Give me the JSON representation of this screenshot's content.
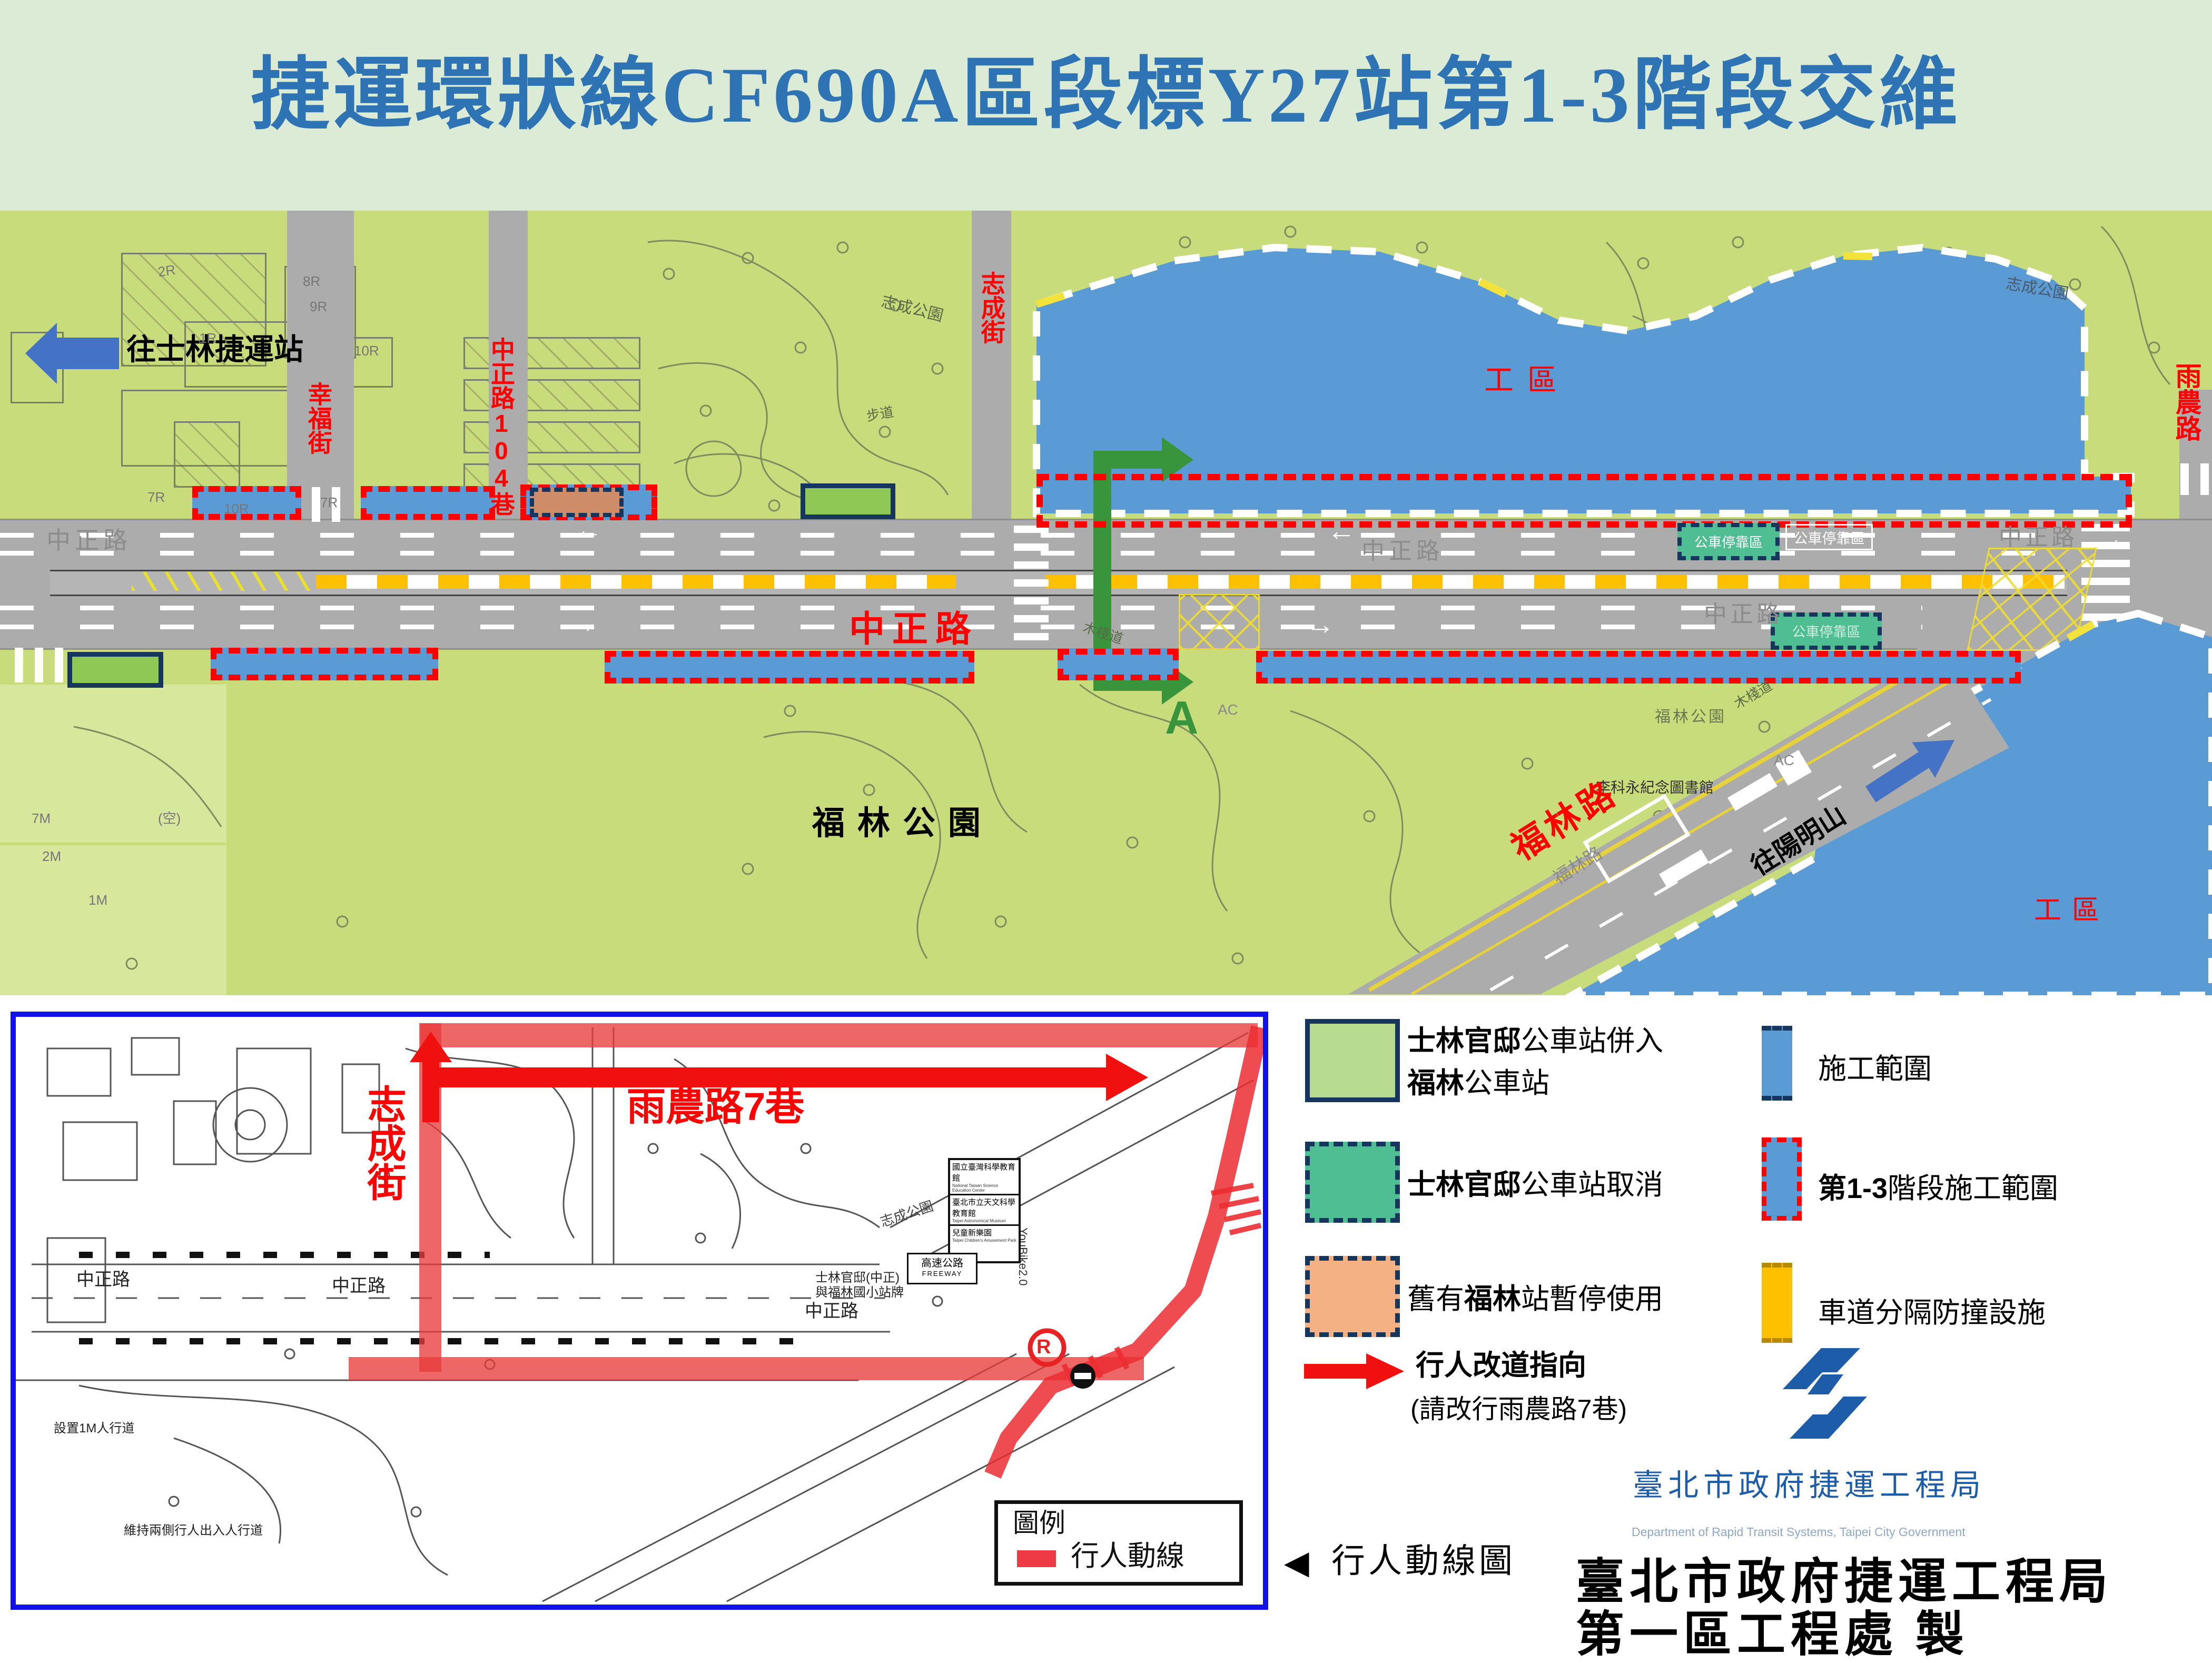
{
  "title": "捷運環狀線CF690A區段標Y27站第1-3階段交維",
  "map": {
    "to_shilin": "往士林捷運站",
    "xingfu_st": "幸福街",
    "zz104": "中正路104巷",
    "zhicheng_st": "志成街",
    "zhicheng_park": "志成公園",
    "budao": "步道",
    "gongqu": "工區",
    "zhongzheng_red": "中正路",
    "zhongzheng": "中正路",
    "fulin_park": "福林公園",
    "library": "李科永紀念圖書館",
    "fulin_rd": "福林路",
    "to_yangmingshan": "往陽明山",
    "yunong_rd": "雨農路",
    "a_marker": "A",
    "bus_bay": "公車停靠區",
    "boardwalk": "木棧道",
    "arrow_left": "←",
    "arrow_right": "→",
    "tiny": {
      "a": "2R",
      "b": "8R",
      "c": "9R",
      "d": "1R",
      "e": "10R",
      "f": "7R",
      "g": "2M",
      "h": "1M",
      "i": "(空)",
      "j": "AC",
      "k": "7M"
    }
  },
  "inset": {
    "zhicheng_st": "志成街",
    "yunong7": "雨農路7巷",
    "zhongzheng": "中正路",
    "zhicheng_park": "志成公園",
    "legend_title": "圖例",
    "legend_item": "行人動線",
    "sign1": "國立臺灣科學教育館",
    "sign1e": "National Taiwan Science Education Center",
    "sign2": "臺北市立天文科學教育館",
    "sign2e": "Taipei Astronomical Museum",
    "sign3": "兒童新樂園",
    "sign3e": "Taipei Children's Amusement Park",
    "freeway": "高速公路",
    "freeway_e": "FREEWAY",
    "busstop_note1": "士林官邸(中正)",
    "busstop_note2": "與福林國小站牌",
    "note_1m": "設置1M人行道",
    "note_ped": "維持兩側行人出入人行道",
    "youbike": "YouBike2.0",
    "r_mark": "R"
  },
  "legend": {
    "merge_bold1": "士林官邸",
    "merge_rest1": "公車站併入",
    "merge_bold2": "福林",
    "merge_rest2": "公車站",
    "cancel_bold": "士林官邸",
    "cancel_rest": "公車站取消",
    "old_pre": "舊有",
    "old_bold": "福林",
    "old_rest": "站暫停使用",
    "divert_title": "行人改道指向",
    "divert_sub": "(請改行雨農路7巷)",
    "construction": "施工範圍",
    "phase_bold": "第1-3",
    "phase_rest": "階段施工範圍",
    "barrier": "車道分隔防撞設施"
  },
  "logo": {
    "cht": "臺北市政府捷運工程局",
    "eng": "Department of Rapid Transit Systems, Taipei City Government"
  },
  "footer": {
    "tri": "◀",
    "ped_map": "行人動線圖",
    "line1": "臺北市政府捷運工程局",
    "line2": "第一區工程處  製"
  },
  "colors": {
    "title_blue": "#2E74B5",
    "work_blue": "#5B9BD5",
    "park_green": "#C9DC7B",
    "legend_green": "#B7DB8F",
    "teal": "#4FBE92",
    "orange_stop": "#F4B183",
    "barrier_yellow": "#FFC000",
    "route_red": "#FF0000",
    "route_green": "#38953C",
    "navy": "#17365D",
    "logo_blue": "#1D5CA9"
  }
}
